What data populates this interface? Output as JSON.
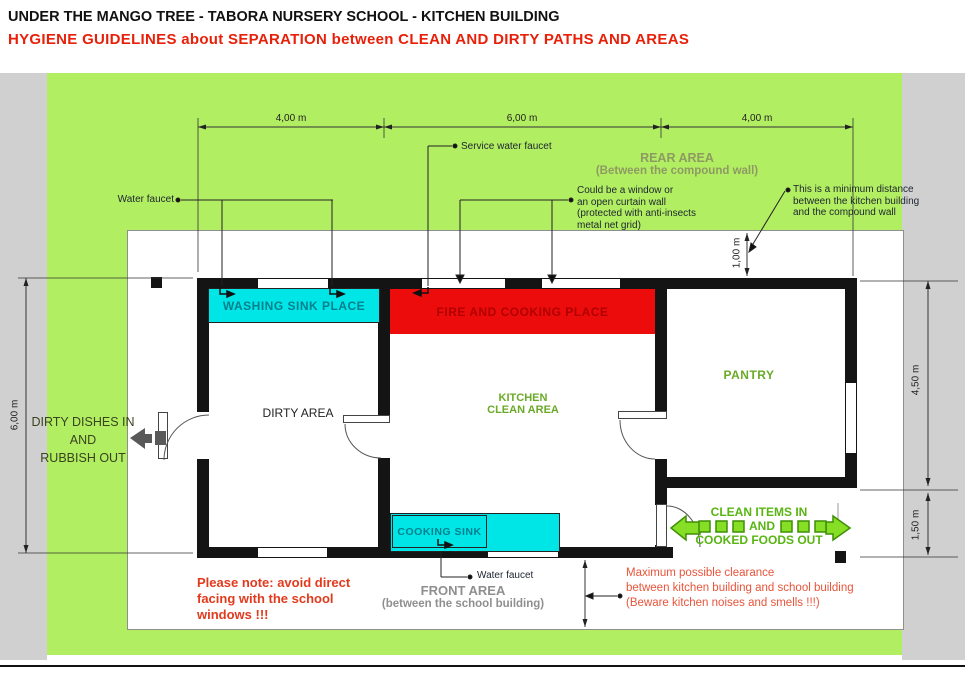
{
  "page": {
    "title": "UNDER THE MANGO TREE  - TABORA NURSERY SCHOOL - KITCHEN BUILDING",
    "subtitle": "HYGIENE GUIDELINES about SEPARATION between CLEAN AND DIRTY PATHS AND AREAS"
  },
  "dimensions": {
    "top_left": "4,00 m",
    "top_mid": "6,00 m",
    "top_right": "4,00 m",
    "left_height": "6,00 m",
    "right_upper": "4,50 m",
    "right_lower": "1,50 m",
    "rear_gap": "1,00 m"
  },
  "areas": {
    "rear_line1": "REAR AREA",
    "rear_line2": "(Between the compound wall)",
    "front_line1": "FRONT AREA",
    "front_line2": "(between the school building)"
  },
  "rooms": {
    "washing_sink": "WASHING SINK PLACE",
    "fire_cooking": "FIRE AND COOKING PLACE",
    "dirty": "DIRTY AREA",
    "kitchen_line1": "KITCHEN",
    "kitchen_line2": "CLEAN AREA",
    "pantry": "PANTRY",
    "cooking_sink": "COOKING SINK"
  },
  "labels": {
    "water_faucet_left": "Water faucet",
    "service_water_faucet": "Service water faucet",
    "water_faucet_bottom": "Water faucet",
    "window_note": [
      "Could be a window or",
      "an open curtain wall",
      "(protected with anti-insects",
      "metal net grid)"
    ],
    "min_distance_note": [
      "This is a minimum distance",
      "between the kitchen building",
      "and the compound wall"
    ]
  },
  "flows": {
    "dirty_line1": "DIRTY DISHES IN",
    "dirty_line2": "AND",
    "dirty_line3": "RUBBISH OUT",
    "clean_line1": "CLEAN ITEMS IN",
    "clean_line2": "AND",
    "clean_line3": "COOKED FOODS OUT"
  },
  "notes": {
    "school_warning": [
      "Please note: avoid direct",
      "facing with the school",
      "windows !!!"
    ],
    "clearance": [
      "Maximum possible clearance",
      "between kitchen building and school building",
      "(Beware kitchen noises and smells !!!)"
    ]
  },
  "colors": {
    "field_green": "#b2ee62",
    "accent_green": "#58b512",
    "cyan": "#00e6e6",
    "red_zone": "#ed0c0c",
    "red_text": "#e23a1c",
    "olive_label": "#8d9a63",
    "kitchen_green": "#6aaa28",
    "gray_band": "#d0d0d0",
    "wall_black": "#141414"
  }
}
